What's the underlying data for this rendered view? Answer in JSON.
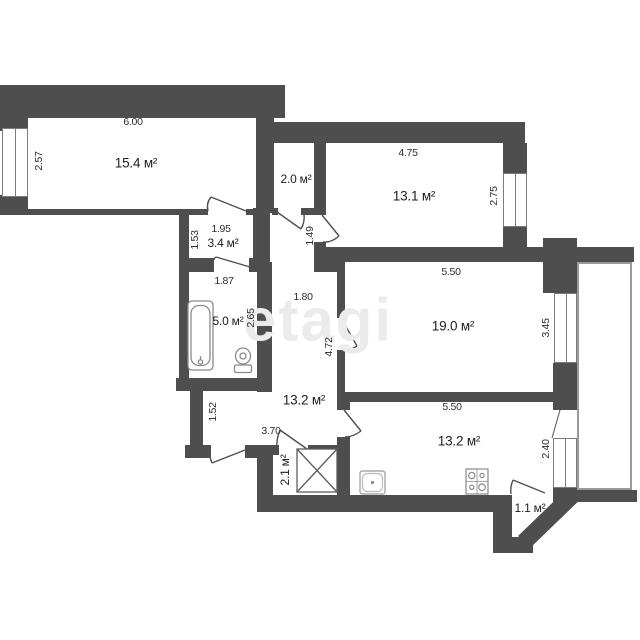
{
  "title": "apartment floor plan",
  "watermark": {
    "text": "etagi"
  },
  "colors": {
    "wall": "#4e4e4e",
    "background": "#ffffff",
    "fixture_line": "#8a8a8a",
    "dimension_text": "#2d2d2d",
    "watermark": "#ebebeb"
  },
  "rooms": [
    {
      "name": "living-room",
      "label": "15.4 м²"
    },
    {
      "name": "balcony-top",
      "label": "2.0 м²"
    },
    {
      "name": "bedroom-right",
      "label": "13.1 м²"
    },
    {
      "name": "anteroom",
      "label": "3.4 м²"
    },
    {
      "name": "bathroom",
      "label": "5.0 м²"
    },
    {
      "name": "bedroom-big",
      "label": "19.0 м²"
    },
    {
      "name": "hallway",
      "label": "13.2 м²"
    },
    {
      "name": "kitchen",
      "label": "13.2 м²"
    },
    {
      "name": "closet",
      "label": "2.1 м²"
    },
    {
      "name": "balcony-bottom",
      "label": "1.1 м²"
    }
  ],
  "dims": [
    {
      "name": "dim-6-00",
      "label": "6.00"
    },
    {
      "name": "dim-2-57",
      "label": "2.57"
    },
    {
      "name": "dim-4-75",
      "label": "4.75"
    },
    {
      "name": "dim-2-75",
      "label": "2.75"
    },
    {
      "name": "dim-1-95",
      "label": "1.95"
    },
    {
      "name": "dim-1-53",
      "label": "1.53"
    },
    {
      "name": "dim-1-49",
      "label": "1.49"
    },
    {
      "name": "dim-1-87",
      "label": "1.87"
    },
    {
      "name": "dim-1-80",
      "label": "1.80"
    },
    {
      "name": "dim-2-65",
      "label": "2.65"
    },
    {
      "name": "dim-5-50-top",
      "label": "5.50"
    },
    {
      "name": "dim-3-45",
      "label": "3.45"
    },
    {
      "name": "dim-4-72",
      "label": "4.72"
    },
    {
      "name": "dim-5-50-bottom",
      "label": "5.50"
    },
    {
      "name": "dim-1-52",
      "label": "1.52"
    },
    {
      "name": "dim-3-70",
      "label": "3.70"
    },
    {
      "name": "dim-2-40",
      "label": "2.40"
    }
  ]
}
